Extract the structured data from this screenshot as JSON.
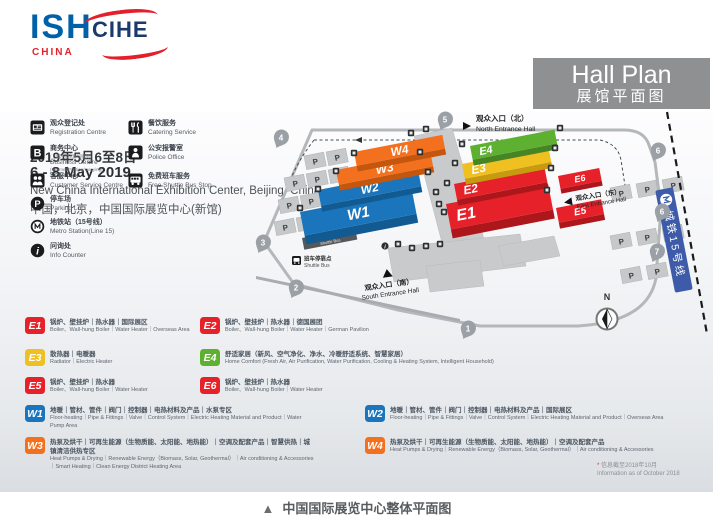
{
  "header": {
    "ish": "ISH",
    "ish_sub": "CHINA",
    "cihe": "CIHE",
    "date_zh": "2019年5月6至8日",
    "date_en": "6 - 8 May 2019",
    "venue_en": "New China International Exhibition Center, Beijing, China",
    "venue_zh": "中国，北京，中国国际展览中心(新馆)"
  },
  "hall_plan_box": {
    "title_en": "Hall Plan",
    "title_zh": "展馆平面图"
  },
  "facilities": [
    {
      "icon": "registration-icon",
      "zh": "观众登记处",
      "en": "Registration Centre"
    },
    {
      "icon": "catering-icon",
      "zh": "餐饮服务",
      "en": "Catering Service"
    },
    {
      "icon": "business-icon",
      "zh": "商务中心",
      "sub_zh": "(上网/打印/复印服务)",
      "en": "Business Centre",
      "sub_en": "(Internet/Printing/Copying)"
    },
    {
      "icon": "police-icon",
      "zh": "公安报警室",
      "en": "Police Office"
    },
    {
      "icon": "customer-service-icon",
      "zh": "客服中心",
      "en": "Customer Service Centre"
    },
    {
      "icon": "shuttle-bus-icon",
      "zh": "免费班车服务",
      "en": "Free Shuttle Bus Stop"
    },
    {
      "icon": "parking-icon",
      "zh": "停车场",
      "en": "Parking Lot"
    },
    {
      "icon": "metro-icon",
      "zh": "地铁站（15号线）",
      "en": "Metro Station(Line 15)"
    },
    {
      "icon": "info-icon",
      "zh": "问询处",
      "en": "Info Counter"
    }
  ],
  "map": {
    "halls": [
      {
        "id": "W1",
        "label": "W1",
        "color": "#1b75bc",
        "front": "#115a92"
      },
      {
        "id": "W2",
        "label": "W2",
        "color": "#1b75bc",
        "front": "#115a92"
      },
      {
        "id": "W3",
        "label": "W3",
        "color": "#f3701e",
        "front": "#c4560e"
      },
      {
        "id": "W4",
        "label": "W4",
        "color": "#f3701e",
        "front": "#c4560e"
      },
      {
        "id": "E1",
        "label": "E1",
        "color": "#e62129",
        "front": "#ad171c"
      },
      {
        "id": "E2",
        "label": "E2",
        "color": "#e62129",
        "front": "#ad171c"
      },
      {
        "id": "E3",
        "label": "E3",
        "color": "#f0c020",
        "front": "#c79b10"
      },
      {
        "id": "E4",
        "label": "E4",
        "color": "#5eb130",
        "front": "#478423"
      },
      {
        "id": "E5",
        "label": "E5",
        "color": "#e62129",
        "front": "#ad171c"
      },
      {
        "id": "E6",
        "label": "E6",
        "color": "#e62129",
        "front": "#ad171c"
      }
    ],
    "entrances": {
      "north": {
        "zh": "观众入口（北）",
        "en": "North Entrance Hall"
      },
      "east": {
        "zh": "观众入口（东）",
        "en": "East Entrance Hall"
      },
      "south": {
        "zh": "观众入口（南）",
        "en": "South Entrance Hall"
      }
    },
    "markers": [
      "5",
      "4",
      "3",
      "2",
      "1",
      "6",
      "6",
      "7"
    ],
    "parking_label": "P",
    "metro_line": "城铁15号线",
    "shuttle": {
      "zh": "班车停靠点",
      "en": "Shuttle Bus"
    },
    "compass_n": "N"
  },
  "legend": [
    {
      "id": "E1",
      "color": "#e62129",
      "zh": "锅炉、壁挂炉｜热水器｜国际展区",
      "en": "Boiler、Wall-hung Boiler｜Water Heater｜Overseas Area"
    },
    {
      "id": "E2",
      "color": "#e62129",
      "zh": "锅炉、壁挂炉｜热水器｜德国展团",
      "en": "Boiler、Wall-hung Boiler｜Water Heater｜German Pavilion"
    },
    {
      "id": "E3",
      "color": "#f0c020",
      "zh": "散热器｜电暖器",
      "en": "Radiator｜Electric Heater"
    },
    {
      "id": "E4",
      "color": "#5eb130",
      "zh": "舒适家居（新风、空气净化、净水、冷暖舒适系统、智慧家居）",
      "en": "Home Comfort (Fresh Air, Air Purification, Water Purification, Cooling & Heating System, Intelligent Household)"
    },
    {
      "id": "E5",
      "color": "#e62129",
      "zh": "锅炉、壁挂炉｜热水器",
      "en": "Boiler、Wall-hung Boiler｜Water Heater"
    },
    {
      "id": "E6",
      "color": "#e62129",
      "zh": "锅炉、壁挂炉｜热水器",
      "en": "Boiler、Wall-hung Boiler｜Water Heater"
    },
    {
      "id": "W1",
      "color": "#1b75bc",
      "zh": "地暖｜管材、管件｜阀门｜控制器｜电热材料及产品｜水泵专区",
      "en": "Floor-heating｜Pipe & Fittings｜Valve｜Control System｜Electric Heating Material and Product｜Water Pump Area"
    },
    {
      "id": "W2",
      "color": "#1b75bc",
      "zh": "地暖｜管材、管件｜阀门｜控制器｜电热材料及产品｜国际展区",
      "en": "Floor-heating｜Pipe & Fittings｜Valve｜Control System｜Electric Heating Material and Product｜Overseas Area"
    },
    {
      "id": "W3",
      "color": "#f3701e",
      "zh": "热泵及烘干｜可再生能源（生物质能、太阳能、地热能）｜空调及配套产品｜智慧供热｜城镇清洁供热专区",
      "en": "Heat Pumps & Drying｜Renewable Energy（Biomass, Solar, Geothermal）｜Air conditioning & Accessories｜Smart Heating｜Clean Energy District Heating Area"
    },
    {
      "id": "W4",
      "color": "#f3701e",
      "zh": "热泵及烘干｜可再生能源（生物质能、太阳能、地热能）｜空调及配套产品",
      "en": "Heat Pumps & Drying｜Renewable Energy（Biomass, Solar, Geothermal）｜Air conditioning & Accessories"
    }
  ],
  "footnote": {
    "zh": "信息截至2018年10月",
    "star": "*",
    "en": "Information as of October 2018"
  },
  "caption": {
    "marker": "▲",
    "text": "中国国际展览中心整体平面图"
  }
}
